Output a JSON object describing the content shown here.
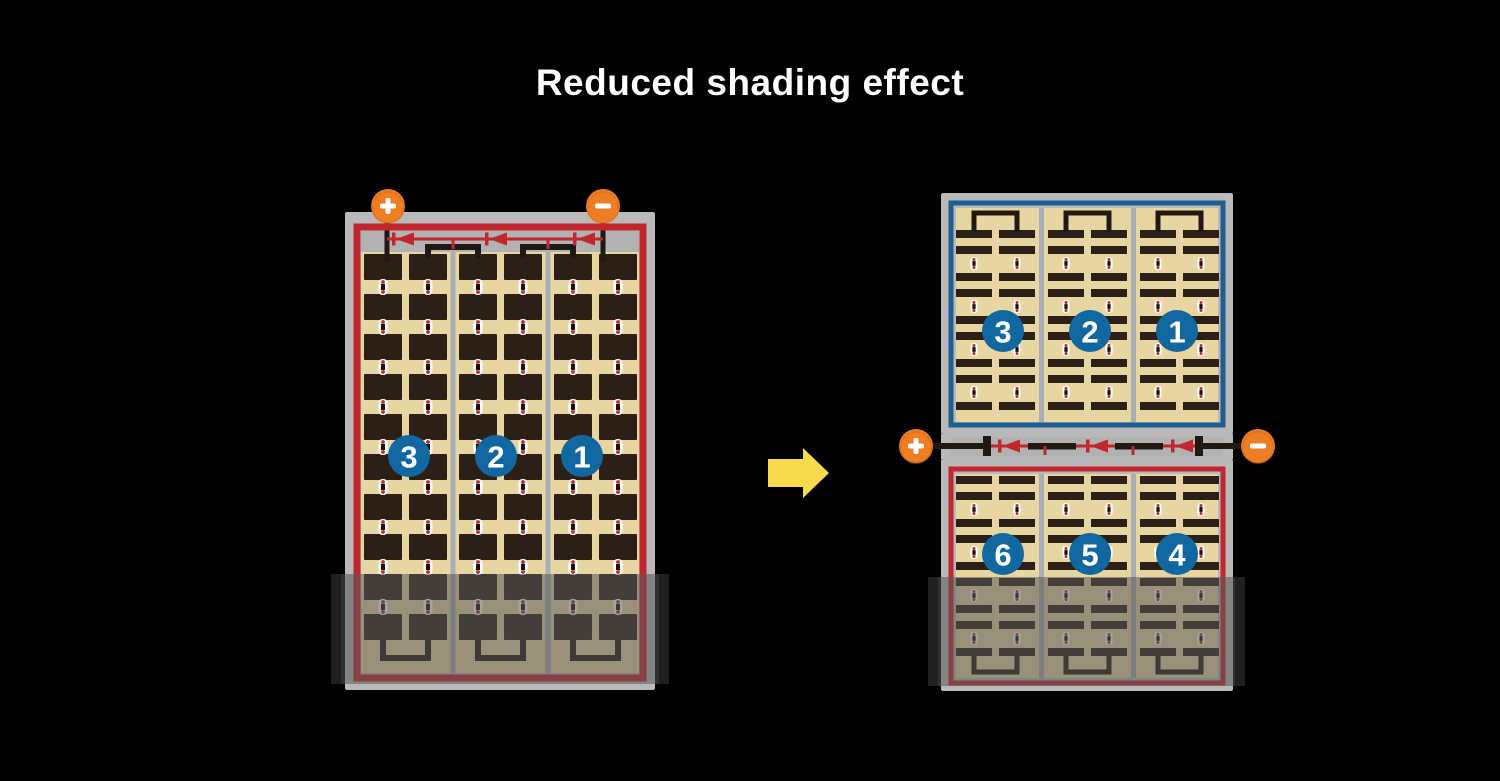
{
  "title": "Reduced shading effect",
  "colors": {
    "background": "#000000",
    "title_text": "#ffffff",
    "panel_frame": "#b9b9b9",
    "panel_inner_gray": "#b2b2b2",
    "cell_tan": "#e7d6a2",
    "cell_dark": "#2b1f16",
    "string_divider": "#a7aeb4",
    "wire_black": "#201812",
    "wire_red": "#c1272d",
    "border_blue": "#1f5e91",
    "badge_blue": "#1168a0",
    "terminal_orange": "#ee7e23",
    "terminal_glyph": "#ffffff",
    "arrow_yellow": "#f8da4d",
    "connector_white": "#ffffff",
    "connector_dot": "#c1272d",
    "badge_text": "#ffffff"
  },
  "before_panel": {
    "terminals": {
      "positive_label": "+",
      "negative_label": "−"
    },
    "string_badges": [
      "3",
      "2",
      "1"
    ],
    "bypass_diodes": 3
  },
  "transform_arrow": {
    "direction": "right"
  },
  "after_stack": {
    "top_panel": {
      "string_badges": [
        "3",
        "2",
        "1"
      ]
    },
    "bottom_panel": {
      "string_badges": [
        "6",
        "5",
        "4"
      ]
    },
    "terminals": {
      "positive_label": "+",
      "negative_label": "−"
    },
    "bypass_diodes": 3
  }
}
